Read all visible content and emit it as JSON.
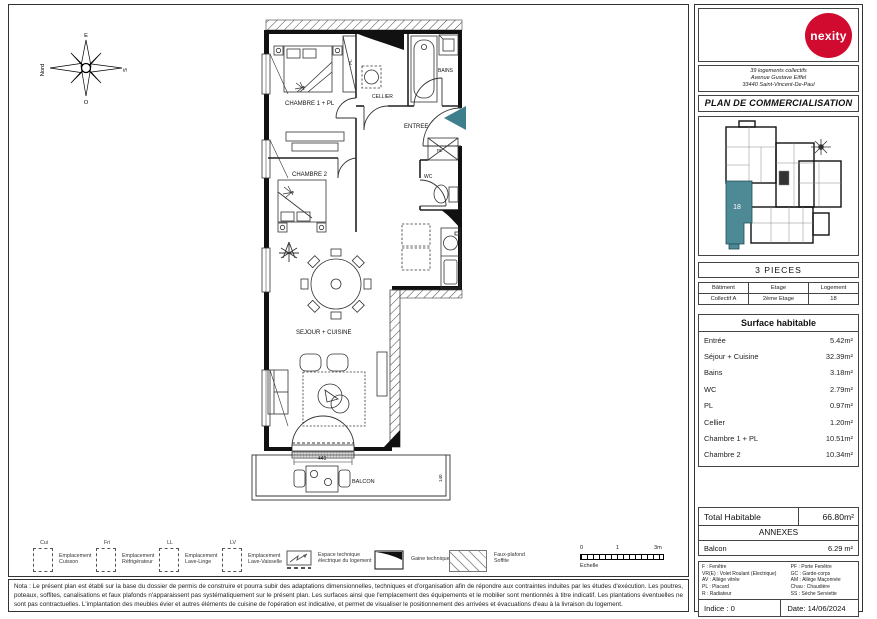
{
  "document": {
    "logo_text": "nexity",
    "address_lines": [
      "39 logements collectifs",
      "Avenue Gustave Eiffel",
      "33440 Saint-Vincent-De-Paul"
    ],
    "title": "PLAN DE COMMERCIALISATION"
  },
  "compass": {
    "north": "Nord",
    "east": "E",
    "south": "S",
    "west": "O"
  },
  "plan": {
    "rooms": {
      "chambre1": "CHAMBRE 1 + PL",
      "chambre2": "CHAMBRE 2",
      "sejour": "SEJOUR + CUISINE",
      "entree": "ENTREE",
      "bains": "BAINS",
      "wc": "WC",
      "cellier": "CELLIER",
      "pl_chambre1": "PL",
      "pl_entree": "PL",
      "balcon": "BALCON"
    },
    "dims": {
      "balcony_width": "449",
      "balcony_depth": "140"
    },
    "accent_color": "#3f7e8c"
  },
  "keyplan": {
    "unit": "18",
    "highlight_color": "#4d8a96"
  },
  "unit_info": {
    "type": "3 PIECES",
    "headers": [
      "Bâtiment",
      "Etage",
      "Logement"
    ],
    "values": [
      "Collectif A",
      "2ème Etage",
      "18"
    ]
  },
  "surface": {
    "title": "Surface habitable",
    "rows": [
      {
        "label": "Entrée",
        "value": "5.42m²"
      },
      {
        "label": "Séjour + Cuisine",
        "value": "32.39m²"
      },
      {
        "label": "Bains",
        "value": "3.18m²"
      },
      {
        "label": "WC",
        "value": "2.79m²"
      },
      {
        "label": "PL",
        "value": "0.97m²"
      },
      {
        "label": "Cellier",
        "value": "1.20m²"
      },
      {
        "label": "Chambre 1 + PL",
        "value": "10.51m²"
      },
      {
        "label": "Chambre 2",
        "value": "10.34m²"
      }
    ],
    "total_label": "Total Habitable",
    "total_value": "66.80m²",
    "annexes_title": "ANNEXES",
    "annexes": [
      {
        "label": "Balcon",
        "value": "6.29 m²"
      }
    ]
  },
  "legend": {
    "emplacements": [
      {
        "abbr": "Cui",
        "line1": "Emplacement",
        "line2": "Cuisson"
      },
      {
        "abbr": "Fri",
        "line1": "Emplacement",
        "line2": "Réfrigérateur"
      },
      {
        "abbr": "LL",
        "line1": "Emplacement",
        "line2": "Lave-Linge"
      },
      {
        "abbr": "LV",
        "line1": "Emplacement",
        "line2": "Lave-Vaisselle"
      }
    ],
    "symbols": [
      {
        "line1": "Espace technique",
        "line2": "électrique du logement"
      },
      {
        "line1": "Gaine technique",
        "line2": ""
      },
      {
        "line1": "Faux-plafond",
        "line2": "Soffite"
      }
    ],
    "scale": {
      "t0": "0",
      "t1": "1",
      "t2": "3m",
      "label": "Echelle"
    }
  },
  "abbreviations": {
    "left": [
      "F : Fenêtre",
      "VR(E) : Volet Roulant (Electrique)",
      "AV : Allège vitrée",
      "PL : Placard",
      "R : Radiateur"
    ],
    "right": [
      "PF : Porte Fenêtre",
      "GC : Garde-corps",
      "AM : Allège Maçonnée",
      "Chau : Chaudière",
      "SS : Sèche Serviette"
    ]
  },
  "footer": {
    "indice": "Indice : 0",
    "date": "Date: 14/06/2024"
  },
  "nota": "Nota : Le présent plan est établi sur la base du dossier de permis de construire et pourra subir des adaptations dimensionnelles, techniques et d'organisation afin de répondre aux contraintes induites par les études d'exécution. Les poutres, poteaux, soffites, canalisations et faux plafonds n'apparaissent pas systématiquement sur le présent plan. Les surfaces ainsi que l'emplacement des équipements et le mobilier sont mentionnés à titre indicatif. Les plantations éventuelles ne sont pas contractuelles. L'implantation des meubles évier et autres éléments de cuisine de l'opération est indicative, et permet de visualiser le positionnement des arrivées et évacuations d'eau à la livraison du logement."
}
